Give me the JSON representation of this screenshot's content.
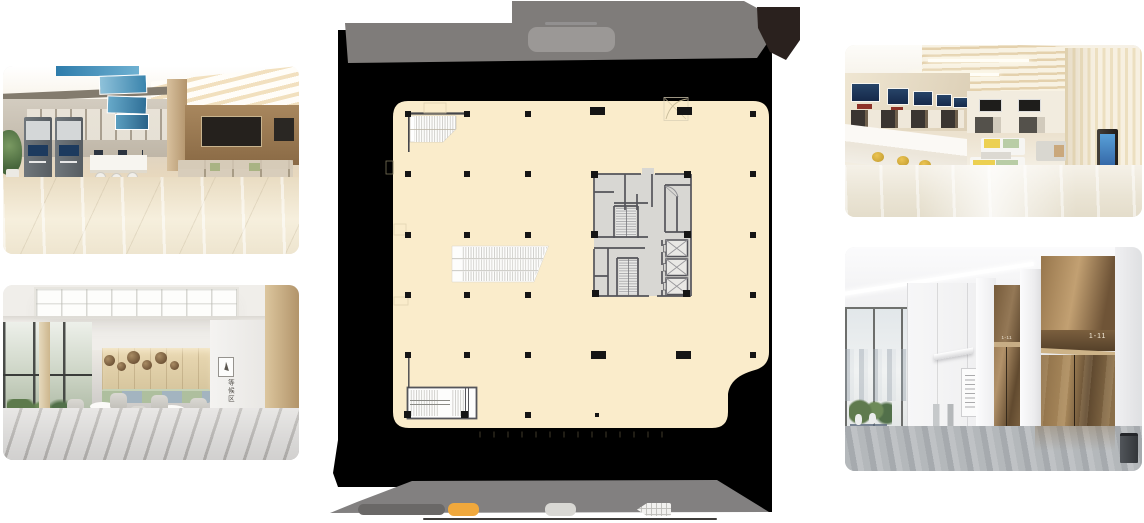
{
  "canvas": {
    "width": 1144,
    "height": 523,
    "background": "#ffffff"
  },
  "floor_plan_panel": {
    "colors": {
      "slab": "#000000",
      "top_face": "#7f7c7a",
      "bottom_face": "#828080",
      "corner_block": "#2a211e",
      "title_plate": "#9b9896",
      "floor_fill": "#faeccb",
      "core_fill": "#d8d7d3",
      "core_wall": "#54545a",
      "column": "#151515",
      "baseline": "#3f3d3b"
    },
    "legend": {
      "swatches": [
        {
          "id": "swatch-dark",
          "color": "#6a6867"
        },
        {
          "id": "swatch-orange",
          "color": "#f0a83c"
        },
        {
          "id": "swatch-light",
          "color": "#d9d8d4"
        },
        {
          "id": "swatch-white",
          "color": "#f2f1ef"
        }
      ]
    }
  },
  "photos": {
    "top_left": {
      "subject": "service hall"
    },
    "bottom_left": {
      "subject": "waiting lounge",
      "sign_text": "等候区"
    },
    "top_right": {
      "subject": "counter hall"
    },
    "bottom_right": {
      "subject": "elevator lobby",
      "elevator_label_near": "1-11",
      "elevator_label_far": "1-11"
    }
  }
}
